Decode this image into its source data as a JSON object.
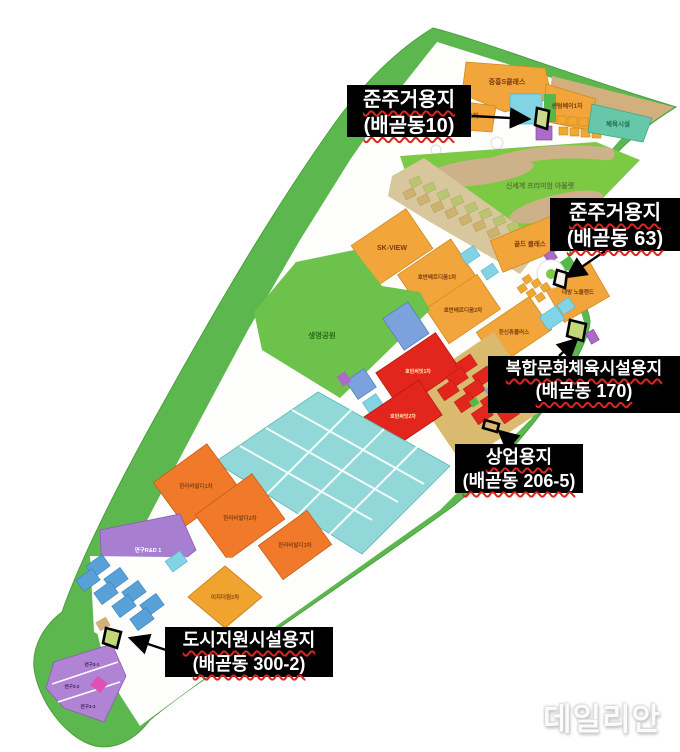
{
  "watermark": {
    "text": "데일리안"
  },
  "callouts": [
    {
      "title": "준주거용지",
      "subtitle": "(배곧동10)"
    },
    {
      "title": "준주거용지",
      "subtitle": "(배곧동 63)"
    },
    {
      "title": "복합문화체육시설용지",
      "subtitle": "(배곧동 170)"
    },
    {
      "title": "상업용지",
      "subtitle": "(배곧동 206-5)"
    },
    {
      "title": "도시지원시설용지",
      "subtitle": "(배곧동 300-2)"
    }
  ],
  "parcels": {
    "joongheung": "중흥S클래스",
    "ezone1": "이지더원1차",
    "centumbay": "센텀베이1차",
    "sports": "체육시설",
    "outlet": "신세계 프리미엄 아울렛",
    "skview": "SK-VIEW",
    "hoban1": "호반베르디움1차",
    "gold": "골드 클래스",
    "daebang": "대방 노블랜드",
    "hoban2": "호반베르디움2차",
    "hanshin": "한신휴플러스",
    "lifepark": "생명공원",
    "summit1": "호반써밋1차",
    "summit2": "호반써밋2차",
    "halla1": "한라비발디1차",
    "halla2": "한라비발디2차",
    "halla3": "한라비발디3차",
    "rnd": "연구R&D 1",
    "ezone2": "이지더원2차",
    "yeongu31": "연구3-1",
    "yeongu32": "연구3-2",
    "yeongu33": "연구3-3"
  },
  "colors": {
    "boundary_green": "#5cb84e",
    "park_green": "#6cc24a",
    "residential_orange": "#f2a53a",
    "commercial_red": "#e3261d",
    "education_cyan": "#92d8d8",
    "research_purple": "#b183d4",
    "support_blue": "#58a0d8",
    "callout_bg": "#000000",
    "callout_text": "#ffffff",
    "callout_underline": "#d8281e",
    "marked_parcel_fill": "#c2d878"
  }
}
